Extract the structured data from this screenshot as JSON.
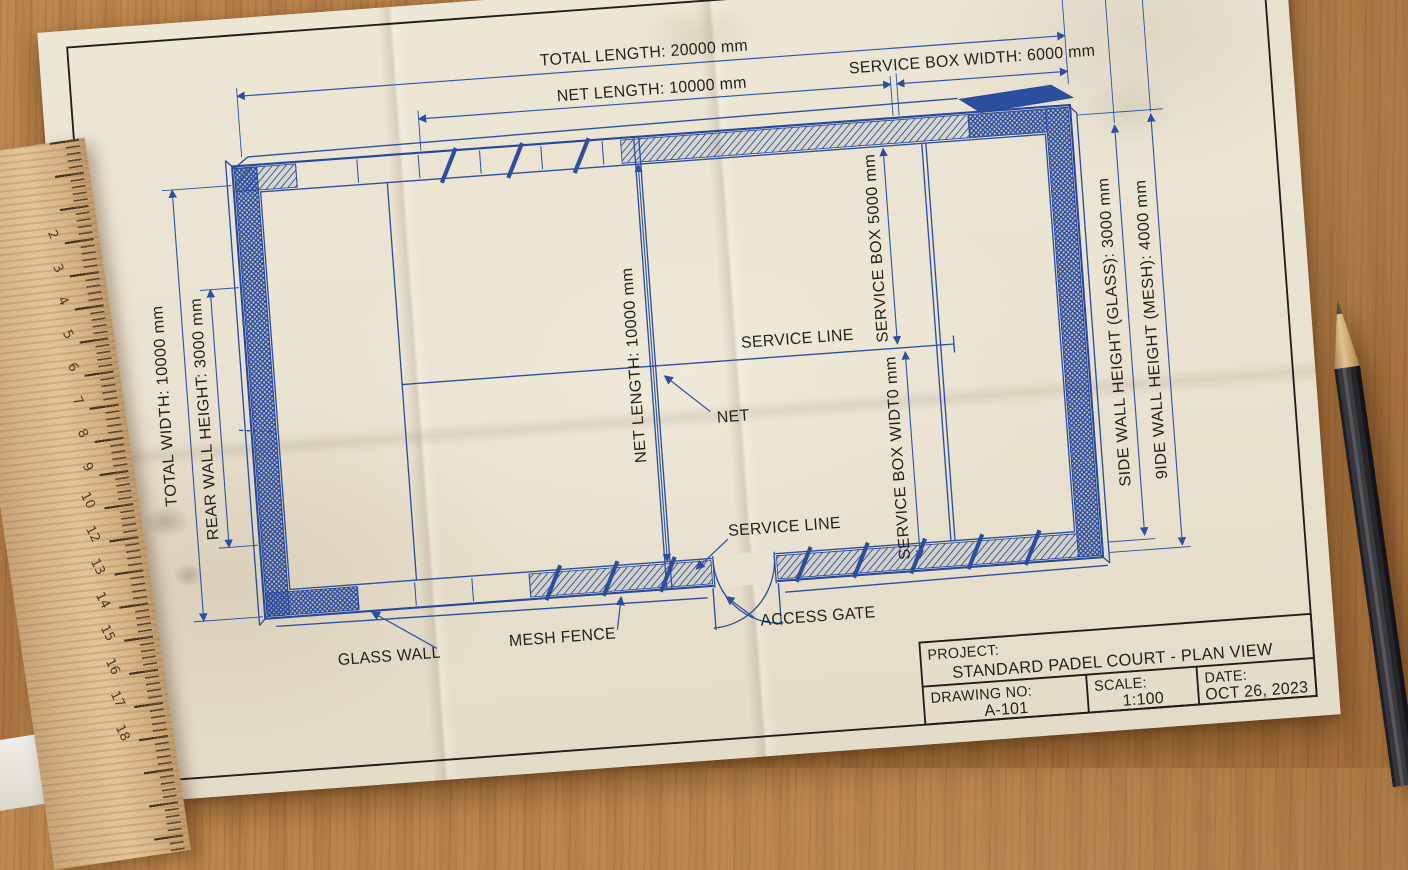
{
  "drawing": {
    "dims": {
      "total_length": "TOTAL LENGTH: 20000 mm",
      "net_length_top": "NET LENGTH: 10000 mm",
      "service_box_width_top": "SERVICE BOX WIDTH: 6000 mm",
      "total_width": "TOTAL WIDTH: 10000 mm",
      "rear_wall_height": "REAR WALL HEIGHT: 3000 mm",
      "net_length_vertical": "NET LENGTH: 10000 mm",
      "service_box": "SERVICE BOX 5000 mm",
      "service_box_width_mid": "SERVICE BOX WIDT0 mm",
      "side_wall_glass": "SIDE WALL HEIGHT (GLASS): 3000 mm",
      "side_wall_mesh": "9IDE WALL HEIGHT (MESH): 4000 mm"
    },
    "callouts": {
      "service_line_mid": "SERVICE LINE",
      "net": "NET",
      "service_line_bottom": "SERVICE LINE",
      "access_gate": "ACCESS GATE",
      "glass_wall": "GLASS WALL",
      "mesh_fence": "MESH FENCE"
    }
  },
  "title_block": {
    "project_label": "PROJECT:",
    "project_value": "STANDARD PADEL COURT - PLAN VIEW",
    "drawing_no_label": "DRAWING NO:",
    "drawing_no_value": "A-101",
    "scale_label": "SCALE:",
    "scale_value": "1:100",
    "date_label": "DATE:",
    "date_value": "OCT 26, 2023"
  },
  "ruler": {
    "numbers": [
      "2",
      "3",
      "4",
      "5",
      "6",
      "7",
      "8",
      "9",
      "10",
      "12",
      "13",
      "14",
      "15",
      "16",
      "17",
      "18"
    ]
  },
  "colors": {
    "blueprint_blue": "#2b4f9e",
    "ink": "#1c1c1a",
    "paper": "#eae3d1",
    "desk_wood": "#b5824d",
    "ruler_wood": "#d6b486",
    "pencil_body": "#2b2b2f"
  }
}
